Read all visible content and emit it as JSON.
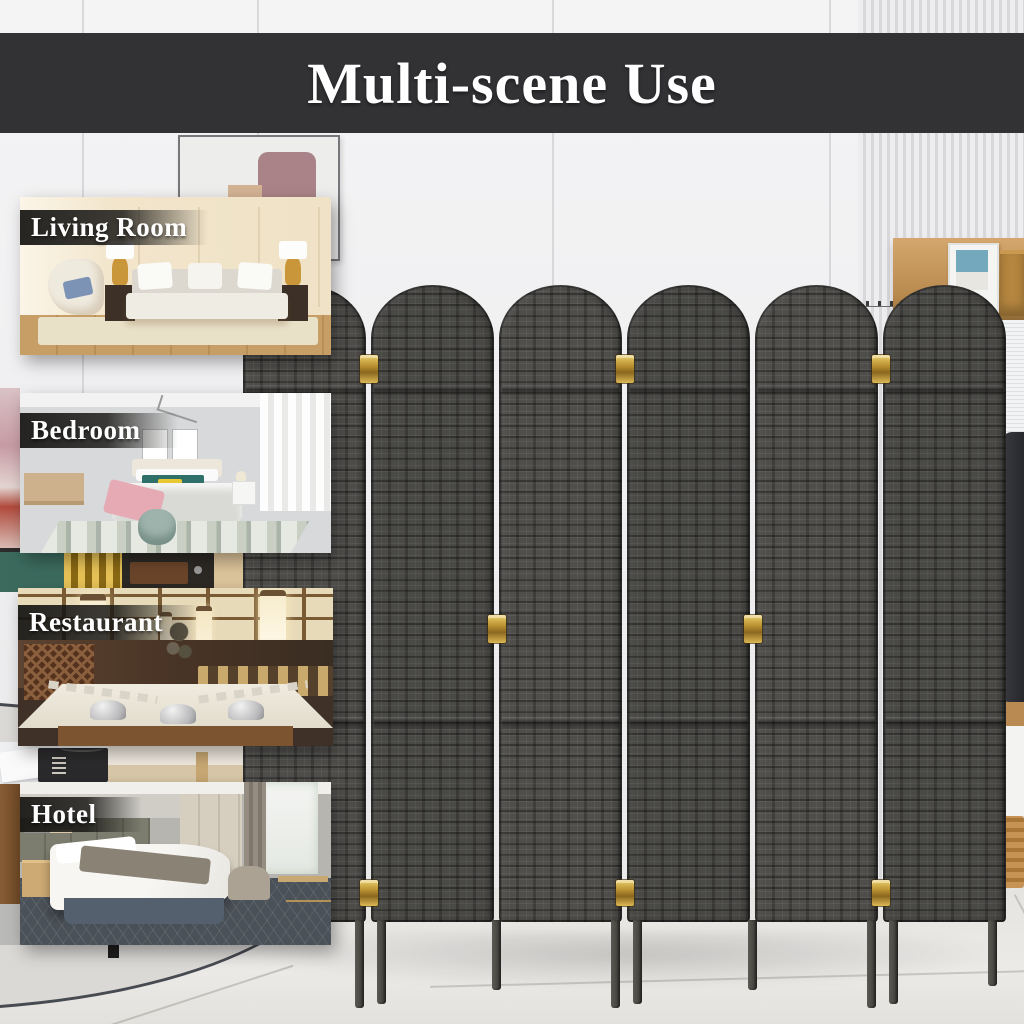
{
  "banner": {
    "title": "Multi-scene Use",
    "bg_color": "#323134",
    "text_color": "#ffffff"
  },
  "scenes": [
    {
      "label": "Living Room"
    },
    {
      "label": "Bedroom"
    },
    {
      "label": "Restaurant"
    },
    {
      "label": "Hotel"
    }
  ],
  "divider": {
    "panel_count": 6,
    "weave_base_color": "#4f4e4b",
    "weave_dark_color": "#3a3936",
    "hinge_color": "#c9a23c"
  },
  "room": {
    "wall_color": "#f1f1f2",
    "floor_color": "#e8e6e2"
  }
}
